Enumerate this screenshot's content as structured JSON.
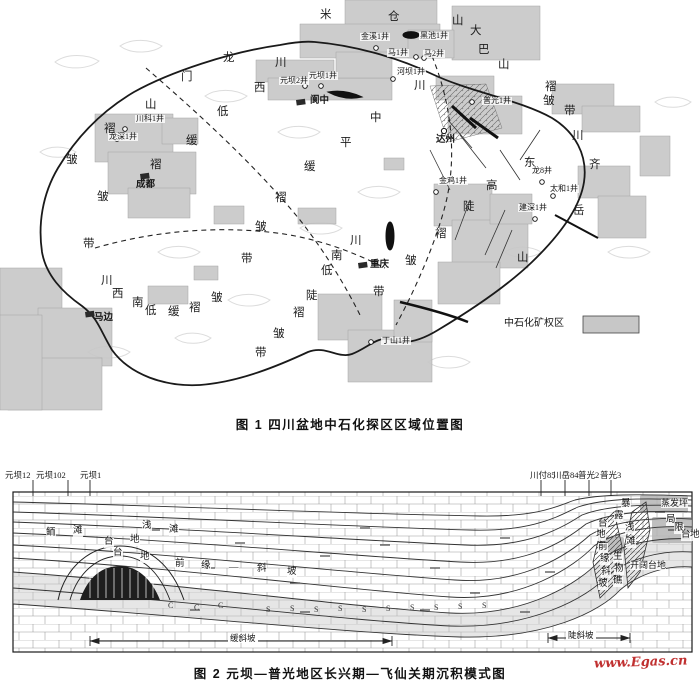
{
  "colors": {
    "permit_gray": "#c7c7c7",
    "shade_gray": "#c8c8c8",
    "reef_dark": "#1e1e1e",
    "watermark_red": "#c03030"
  },
  "watermark": "www.Egas.cn",
  "fig1": {
    "caption": "图 1  四川盆地中石化探区区域位置图",
    "legend_label": "中石化矿权区",
    "region_chars": [
      {
        "t": "米",
        "x": 320,
        "y": 10
      },
      {
        "t": "仓",
        "x": 388,
        "y": 12
      },
      {
        "t": "山",
        "x": 452,
        "y": 16
      },
      {
        "t": "大",
        "x": 470,
        "y": 26
      },
      {
        "t": "巴",
        "x": 478,
        "y": 45
      },
      {
        "t": "山",
        "x": 498,
        "y": 60
      },
      {
        "t": "褶",
        "x": 545,
        "y": 82
      },
      {
        "t": "皱",
        "x": 543,
        "y": 96
      },
      {
        "t": "带",
        "x": 564,
        "y": 106
      },
      {
        "t": "龙",
        "x": 223,
        "y": 53
      },
      {
        "t": "门",
        "x": 181,
        "y": 72
      },
      {
        "t": "山",
        "x": 145,
        "y": 100
      },
      {
        "t": "褶",
        "x": 104,
        "y": 124
      },
      {
        "t": "皱",
        "x": 66,
        "y": 155
      },
      {
        "t": "川",
        "x": 275,
        "y": 58
      },
      {
        "t": "西",
        "x": 254,
        "y": 83
      },
      {
        "t": "低",
        "x": 217,
        "y": 107
      },
      {
        "t": "缓",
        "x": 186,
        "y": 136
      },
      {
        "t": "褶",
        "x": 150,
        "y": 160
      },
      {
        "t": "皱",
        "x": 97,
        "y": 192
      },
      {
        "t": "带",
        "x": 83,
        "y": 239
      },
      {
        "t": "川",
        "x": 414,
        "y": 81
      },
      {
        "t": "中",
        "x": 370,
        "y": 113
      },
      {
        "t": "平",
        "x": 340,
        "y": 138
      },
      {
        "t": "缓",
        "x": 304,
        "y": 162
      },
      {
        "t": "褶",
        "x": 275,
        "y": 193
      },
      {
        "t": "皱",
        "x": 255,
        "y": 222
      },
      {
        "t": "带",
        "x": 241,
        "y": 254
      },
      {
        "t": "川",
        "x": 572,
        "y": 131
      },
      {
        "t": "东",
        "x": 524,
        "y": 158
      },
      {
        "t": "高",
        "x": 486,
        "y": 181
      },
      {
        "t": "陡",
        "x": 463,
        "y": 202
      },
      {
        "t": "褶",
        "x": 435,
        "y": 229
      },
      {
        "t": "皱",
        "x": 405,
        "y": 256
      },
      {
        "t": "带",
        "x": 373,
        "y": 287
      },
      {
        "t": "川",
        "x": 350,
        "y": 236
      },
      {
        "t": "南",
        "x": 331,
        "y": 251
      },
      {
        "t": "低",
        "x": 321,
        "y": 266
      },
      {
        "t": "陡",
        "x": 306,
        "y": 291
      },
      {
        "t": "褶",
        "x": 293,
        "y": 308
      },
      {
        "t": "皱",
        "x": 273,
        "y": 329
      },
      {
        "t": "带",
        "x": 255,
        "y": 348
      },
      {
        "t": "川",
        "x": 101,
        "y": 276
      },
      {
        "t": "西",
        "x": 112,
        "y": 289
      },
      {
        "t": "南",
        "x": 132,
        "y": 298
      },
      {
        "t": "低",
        "x": 145,
        "y": 306
      },
      {
        "t": "缓",
        "x": 168,
        "y": 307
      },
      {
        "t": "褶",
        "x": 189,
        "y": 303
      },
      {
        "t": "皱",
        "x": 211,
        "y": 293
      },
      {
        "t": "齐",
        "x": 589,
        "y": 160
      },
      {
        "t": "岳",
        "x": 573,
        "y": 206
      },
      {
        "t": "山",
        "x": 517,
        "y": 253
      }
    ],
    "wells": [
      {
        "label": "金溪1井",
        "lx": 360,
        "ly": 33,
        "cx": 376,
        "cy": 48
      },
      {
        "label": "黑池1井",
        "lx": 419,
        "ly": 32,
        "cx": null,
        "cy": null
      },
      {
        "label": "马1井",
        "lx": 387,
        "ly": 49,
        "cx": 416,
        "cy": 57
      },
      {
        "label": "马2井",
        "lx": 423,
        "ly": 50,
        "cx": 424,
        "cy": 58
      },
      {
        "label": "元坝1井",
        "lx": 308,
        "ly": 72,
        "cx": 321,
        "cy": 86
      },
      {
        "label": "元坝2井",
        "lx": 279,
        "ly": 77,
        "cx": 305,
        "cy": 86
      },
      {
        "label": "河坝1井",
        "lx": 396,
        "ly": 68,
        "cx": 393,
        "cy": 79
      },
      {
        "label": "普光1井",
        "lx": 482,
        "ly": 97,
        "cx": 472,
        "cy": 102
      },
      {
        "label": "川科1井",
        "lx": 135,
        "ly": 115,
        "cx": 125,
        "cy": 129
      },
      {
        "label": "龙深1井",
        "lx": 108,
        "ly": 133,
        "cx": 117,
        "cy": 139
      },
      {
        "label": "龙8井",
        "lx": 531,
        "ly": 167,
        "cx": 542,
        "cy": 182
      },
      {
        "label": "太和1井",
        "lx": 549,
        "ly": 185,
        "cx": 553,
        "cy": 196
      },
      {
        "label": "金鸡1井",
        "lx": 438,
        "ly": 177,
        "cx": 436,
        "cy": 192
      },
      {
        "label": "建深1井",
        "lx": 518,
        "ly": 204,
        "cx": 535,
        "cy": 219
      },
      {
        "label": "丁山1井",
        "lx": 381,
        "ly": 337,
        "cx": 371,
        "cy": 342
      }
    ],
    "cities": [
      {
        "label": "成都",
        "lx": 136,
        "ly": 181,
        "mx": 140,
        "my": 174,
        "type": "block"
      },
      {
        "label": "阆中",
        "lx": 310,
        "ly": 97,
        "mx": 296,
        "my": 100,
        "type": "block"
      },
      {
        "label": "达州",
        "lx": 436,
        "ly": 136,
        "mx": 444,
        "my": 131,
        "type": "ring"
      },
      {
        "label": "重庆",
        "lx": 370,
        "ly": 261,
        "mx": 358,
        "my": 263,
        "type": "block"
      },
      {
        "label": "马边",
        "lx": 94,
        "ly": 314,
        "mx": 85,
        "my": 312,
        "type": "block"
      }
    ]
  },
  "fig2": {
    "caption": "图 2  元坝—普光地区长兴期—飞仙关期沉积模式图",
    "top_wells": [
      {
        "label": "元坝12",
        "x": 5,
        "tx": 33
      },
      {
        "label": "元坝102",
        "x": 36,
        "tx": 68
      },
      {
        "label": "元坝1",
        "x": 80,
        "tx": 90
      },
      {
        "label": "川付85",
        "x": 530,
        "tx": 541
      },
      {
        "label": "川岳84",
        "x": 553,
        "tx": 565
      },
      {
        "label": "普光2",
        "x": 578,
        "tx": 589
      },
      {
        "label": "普光3",
        "x": 600,
        "tx": 611
      }
    ],
    "facies_char_labels": [
      {
        "name": "鲕滩",
        "chars": [
          {
            "t": "鲕",
            "x": 46,
            "y": 529
          },
          {
            "t": "滩",
            "x": 73,
            "y": 527
          }
        ]
      },
      {
        "name": "台地",
        "chars": [
          {
            "t": "台",
            "x": 104,
            "y": 538
          },
          {
            "t": "地",
            "x": 130,
            "y": 536
          }
        ]
      },
      {
        "name": "浅滩",
        "chars": [
          {
            "t": "浅",
            "x": 142,
            "y": 522
          },
          {
            "t": "滩",
            "x": 169,
            "y": 526
          }
        ]
      },
      {
        "name": "台地前缘—斜坡",
        "chars": [
          {
            "t": "台",
            "x": 113,
            "y": 549
          },
          {
            "t": "地",
            "x": 140,
            "y": 553
          },
          {
            "t": "前",
            "x": 175,
            "y": 560
          },
          {
            "t": "缘",
            "x": 201,
            "y": 562
          },
          {
            "t": "—",
            "x": 229,
            "y": 564
          },
          {
            "t": "斜",
            "x": 257,
            "y": 565
          },
          {
            "t": "坡",
            "x": 287,
            "y": 568
          }
        ]
      },
      {
        "name": "暴露浅滩",
        "chars": [
          {
            "t": "暴",
            "x": 621,
            "y": 500
          },
          {
            "t": "露",
            "x": 614,
            "y": 512
          },
          {
            "t": "浅",
            "x": 625,
            "y": 524
          },
          {
            "t": "滩",
            "x": 626,
            "y": 538
          }
        ]
      },
      {
        "name": "局限台地",
        "chars": [
          {
            "t": "局",
            "x": 666,
            "y": 516
          },
          {
            "t": "限",
            "x": 674,
            "y": 524
          },
          {
            "t": "台",
            "x": 681,
            "y": 531
          },
          {
            "t": "地",
            "x": 690,
            "y": 531
          }
        ]
      },
      {
        "name": "台地前缘斜坡",
        "chars": [
          {
            "t": "台",
            "x": 598,
            "y": 520
          },
          {
            "t": "地",
            "x": 596,
            "y": 531
          },
          {
            "t": "前",
            "x": 598,
            "y": 543
          },
          {
            "t": "缘",
            "x": 600,
            "y": 555
          },
          {
            "t": "斜",
            "x": 601,
            "y": 568
          },
          {
            "t": "坡",
            "x": 598,
            "y": 580
          }
        ]
      },
      {
        "name": "生物礁",
        "chars": [
          {
            "t": "生",
            "x": 613,
            "y": 553
          },
          {
            "t": "物",
            "x": 614,
            "y": 565
          },
          {
            "t": "礁",
            "x": 613,
            "y": 577
          }
        ]
      }
    ],
    "facies_text_labels": [
      {
        "text": "蒸发坪",
        "x": 661,
        "y": 499
      },
      {
        "text": "开阔台地",
        "x": 630,
        "y": 561
      }
    ],
    "formation_codes": [
      {
        "t": "C",
        "x": 168,
        "y": 602
      },
      {
        "t": "C",
        "x": 194,
        "y": 604
      },
      {
        "t": "C",
        "x": 218,
        "y": 602
      },
      {
        "t": "S",
        "x": 266,
        "y": 606
      },
      {
        "t": "S",
        "x": 290,
        "y": 605
      },
      {
        "t": "S",
        "x": 314,
        "y": 606
      },
      {
        "t": "S",
        "x": 338,
        "y": 605
      },
      {
        "t": "S",
        "x": 362,
        "y": 606
      },
      {
        "t": "S",
        "x": 386,
        "y": 605
      },
      {
        "t": "S",
        "x": 410,
        "y": 604
      },
      {
        "t": "S",
        "x": 434,
        "y": 604
      },
      {
        "t": "S",
        "x": 458,
        "y": 603
      },
      {
        "t": "S",
        "x": 482,
        "y": 602
      }
    ],
    "scale_left": "缓斜坡",
    "scale_right": "陡斜坡"
  }
}
